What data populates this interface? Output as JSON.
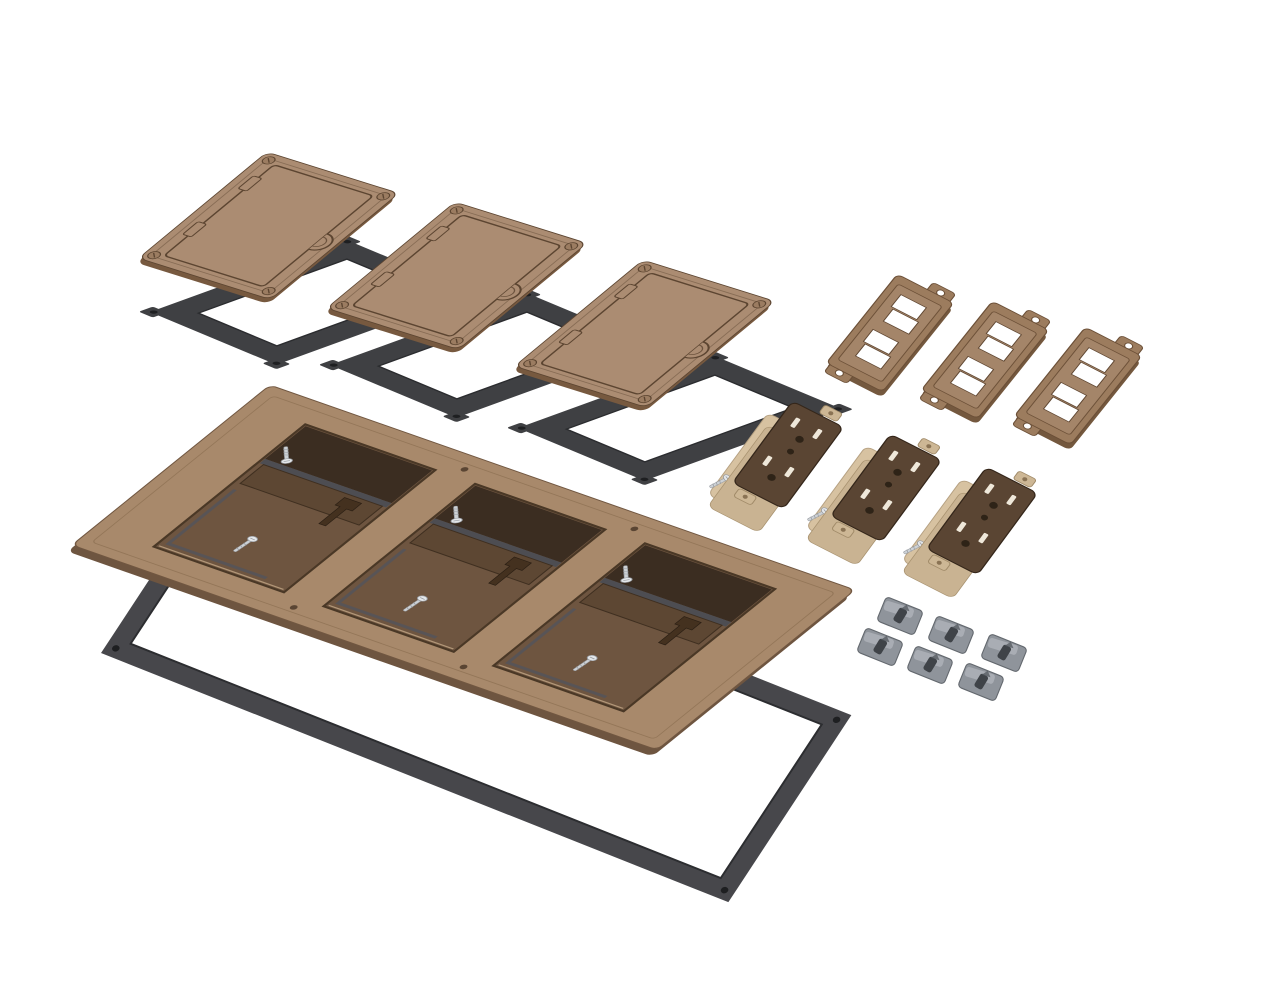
{
  "meta": {
    "description": "Exploded product render of a three-gang brown floor-box cover kit on a white background. No text is visible in the image.",
    "background": "#ffffff"
  },
  "product": {
    "kind": "floor-box-cover-kit",
    "finish": "brown",
    "gangs": 3
  },
  "parts": [
    {
      "id": "flip-lid-cover-plate",
      "label": "hinged flip-lid cover plate",
      "quantity": 3,
      "color": "#ab8c72"
    },
    {
      "id": "cover-gasket",
      "label": "cover gasket with corner holes",
      "quantity": 3,
      "color": "#3f4043"
    },
    {
      "id": "three-gang-frame",
      "label": "three-gang mounting frame with latches and screws",
      "quantity": 1,
      "color": "#a8896b"
    },
    {
      "id": "frame-gasket",
      "label": "large frame gasket",
      "quantity": 1,
      "color": "#47474b"
    },
    {
      "id": "low-voltage-insert-plate",
      "label": "low-voltage insert plate with two keystone openings",
      "quantity": 3,
      "color": "#9c7c5e"
    },
    {
      "id": "duplex-receptacle",
      "label": "brown duplex receptacle with tan body",
      "quantity": 3,
      "color": "#5a4533"
    },
    {
      "id": "wedge-clamp",
      "label": "gray wedge clamp",
      "quantity": 6,
      "color": "#8f949b"
    },
    {
      "id": "mounting-screw",
      "label": "silver mounting screw",
      "quantity": 8,
      "color": "#cdd1d5"
    }
  ],
  "colors": {
    "background": "#ffffff",
    "cover": "#ab8c72",
    "cover_edge": "#77593f",
    "cover_line": "#5c4531",
    "cover_screw": "#9b7c61",
    "gasket": "#3f4043",
    "gasket_hole": "#1e1f21",
    "frame": "#a8896b",
    "frame_edge": "#6e5540",
    "frame_recess": "#3b2d21",
    "bracket": "#5d4733",
    "latch": "#44311f",
    "frame_gasket": "#47474b",
    "gray_liner": "#55555a",
    "lv": "#9c7c5e",
    "lv_edge": "#74583e",
    "lv_raised": "#a5866a",
    "lv_line": "#6b4f37",
    "recep_face": "#5a4533",
    "recep_line": "#34261a",
    "recep_body": "#d7c2a1",
    "recep_mid": "#c9b392",
    "recep_ear": "#cdb795",
    "slot": "#efe8da",
    "hole_dark": "#2e2317",
    "screw_silver": "#cdd1d5",
    "screw_head": "#e4e7ea",
    "screw_line": "#969aa0",
    "clip": "#8f949b",
    "clip_top": "#aeb2b9",
    "clip_hole": "#3f4348",
    "clip_line": "#63686e",
    "green": "#4c7d46",
    "brass": "#a98a52",
    "bevel_light": "#c3a887"
  }
}
